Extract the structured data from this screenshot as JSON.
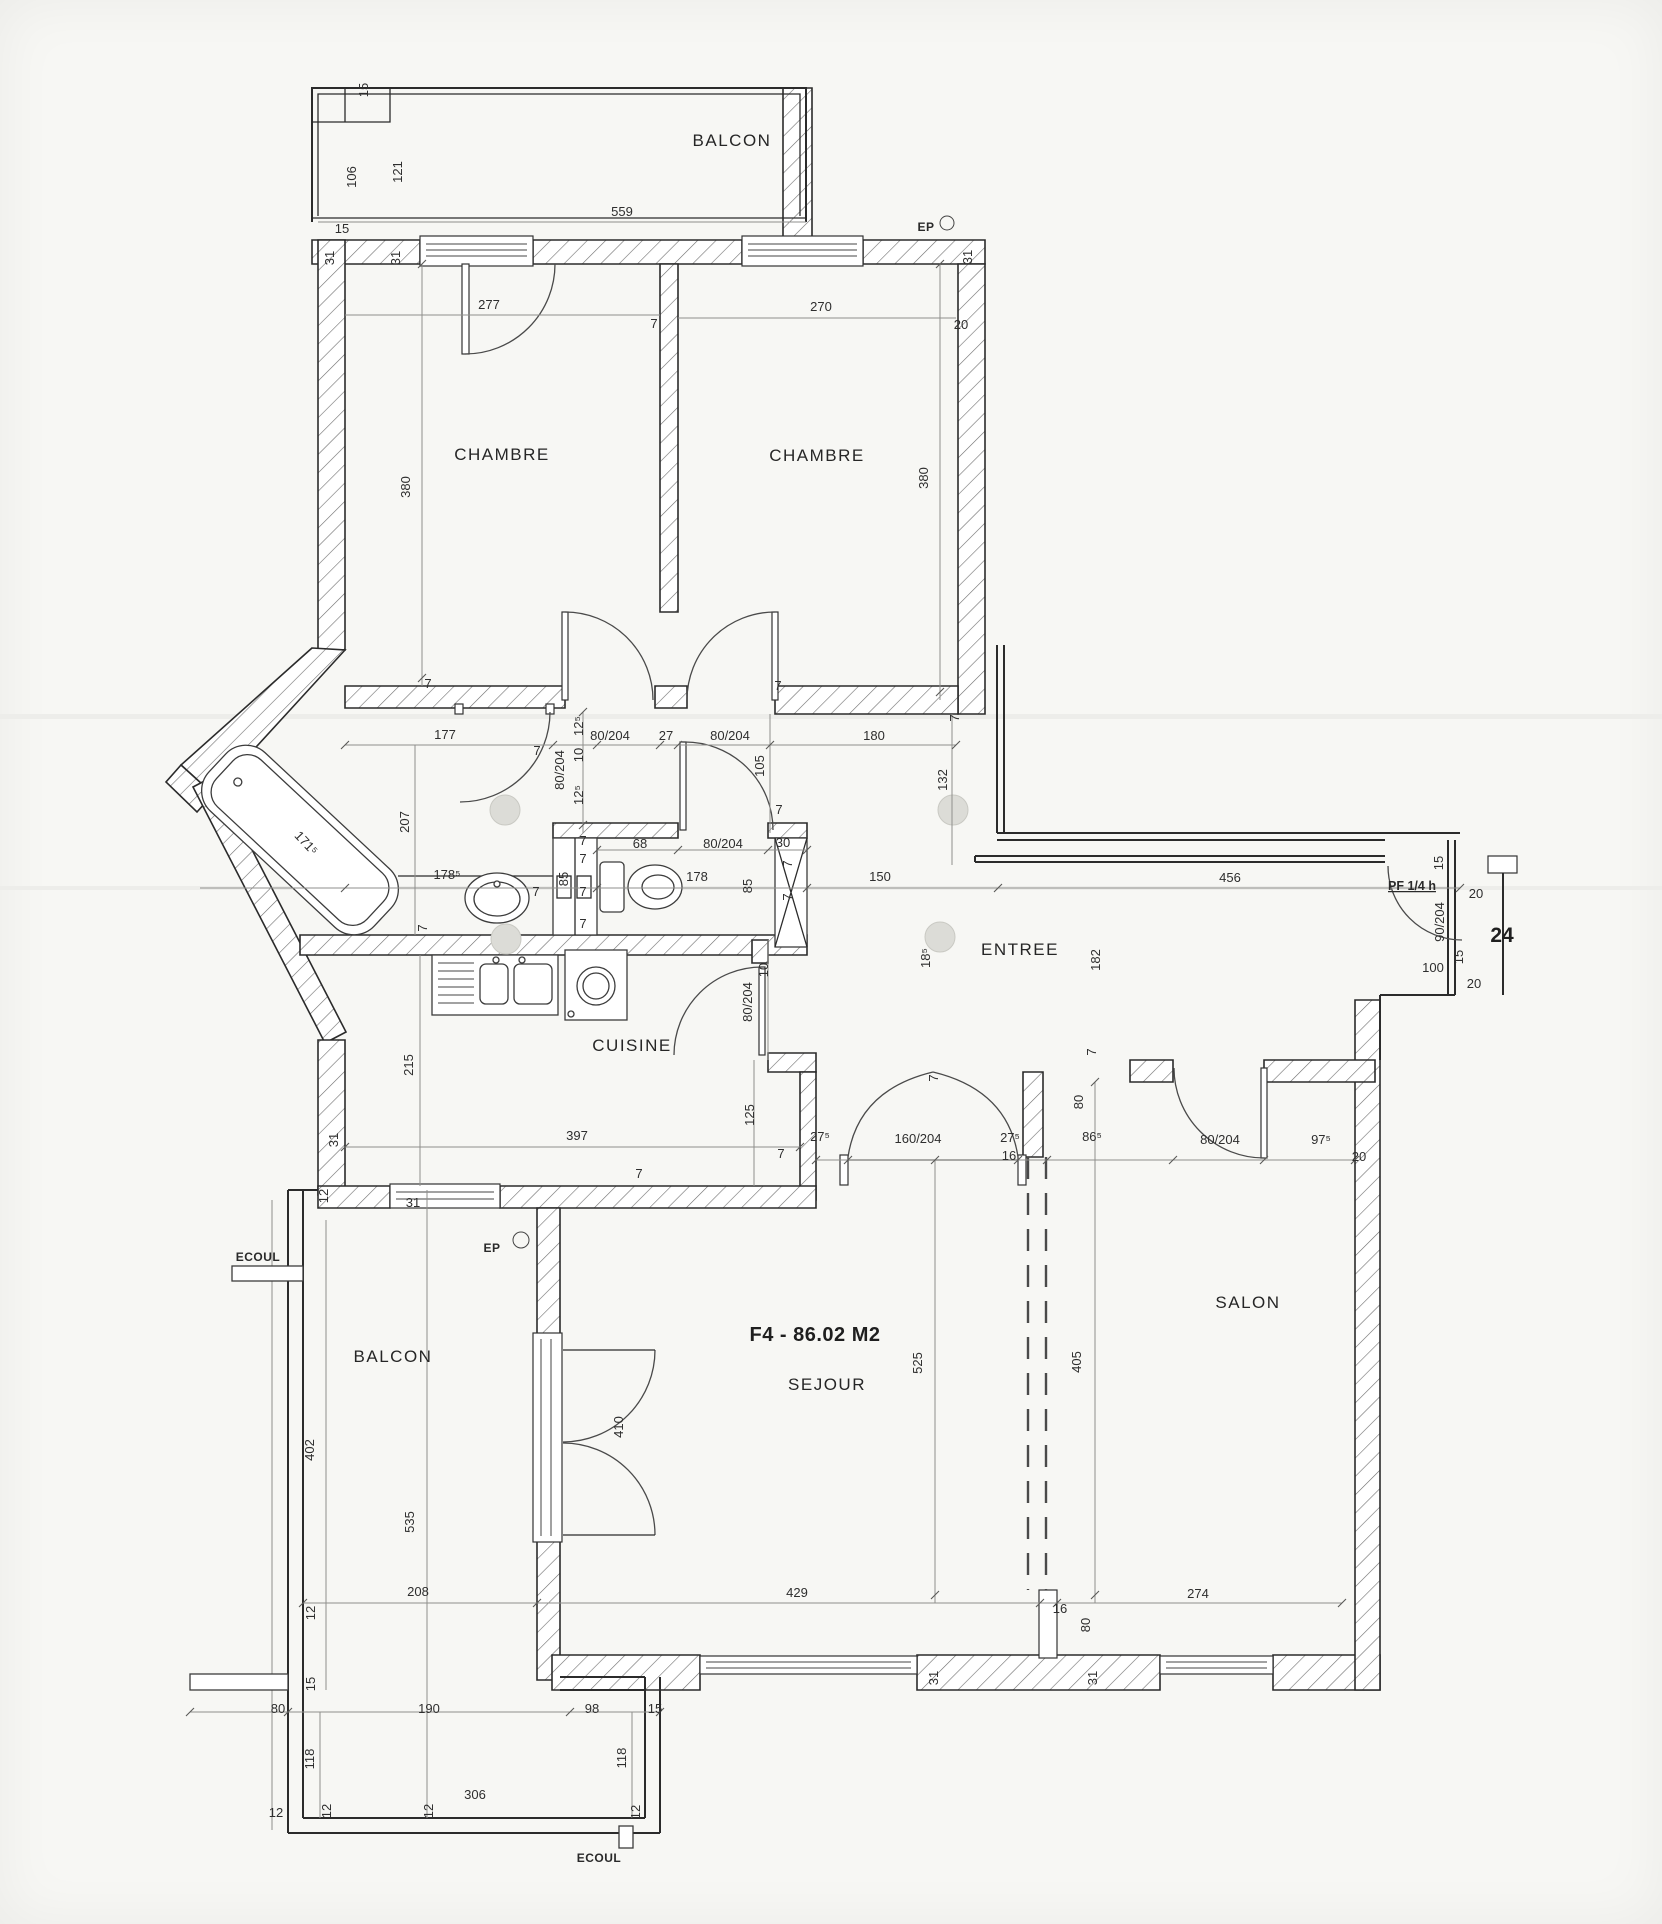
{
  "document": {
    "kind": "scanned apartment floor plan"
  },
  "theme": {
    "paper": "#f7f7f4",
    "line": "#2b2b2b",
    "hatch": "#6e6e6e",
    "dim_text": "#2e2e2e"
  },
  "plan": {
    "area_label": {
      "text": "F4 - 86.02 M2",
      "x": 815,
      "y": 1341
    },
    "unit_number": {
      "text": "24",
      "x": 1502,
      "y": 942
    },
    "door_tag": {
      "text": "PF 1/4 h",
      "x": 1412,
      "y": 890
    },
    "rooms": [
      {
        "label": "BALCON",
        "x": 732,
        "y": 146
      },
      {
        "label": "CHAMBRE",
        "x": 502,
        "y": 460
      },
      {
        "label": "CHAMBRE",
        "x": 817,
        "y": 461
      },
      {
        "label": "CUISINE",
        "x": 632,
        "y": 1051
      },
      {
        "label": "ENTREE",
        "x": 1020,
        "y": 955
      },
      {
        "label": "SALON",
        "x": 1248,
        "y": 1308
      },
      {
        "label": "SEJOUR",
        "x": 827,
        "y": 1390
      },
      {
        "label": "BALCON",
        "x": 393,
        "y": 1362
      }
    ],
    "annotations": [
      {
        "text": "EP",
        "x": 926,
        "y": 231
      },
      {
        "text": "EP",
        "x": 492,
        "y": 1252
      },
      {
        "text": "ECOUL",
        "x": 258,
        "y": 1261
      },
      {
        "text": "ECOUL",
        "x": 599,
        "y": 1862
      }
    ],
    "dims": [
      {
        "t": "15",
        "x": 368,
        "y": 90,
        "r": -90
      },
      {
        "t": "106",
        "x": 356,
        "y": 177,
        "r": -90
      },
      {
        "t": "121",
        "x": 402,
        "y": 172,
        "r": -90
      },
      {
        "t": "559",
        "x": 622,
        "y": 216
      },
      {
        "t": "15",
        "x": 342,
        "y": 233
      },
      {
        "t": "31",
        "x": 334,
        "y": 258,
        "r": -90
      },
      {
        "t": "31",
        "x": 400,
        "y": 258,
        "r": -90
      },
      {
        "t": "31",
        "x": 972,
        "y": 257,
        "r": -90
      },
      {
        "t": "277",
        "x": 489,
        "y": 309
      },
      {
        "t": "270",
        "x": 821,
        "y": 311
      },
      {
        "t": "7",
        "x": 654,
        "y": 328
      },
      {
        "t": "20",
        "x": 961,
        "y": 329
      },
      {
        "t": "380",
        "x": 410,
        "y": 487,
        "r": -90
      },
      {
        "t": "380",
        "x": 928,
        "y": 478,
        "r": -90
      },
      {
        "t": "7",
        "x": 428,
        "y": 688
      },
      {
        "t": "7",
        "x": 778,
        "y": 690
      },
      {
        "t": "177",
        "x": 445,
        "y": 739
      },
      {
        "t": "7",
        "x": 537,
        "y": 755
      },
      {
        "t": "12⁵",
        "x": 583,
        "y": 726,
        "r": -90
      },
      {
        "t": "80/204",
        "x": 564,
        "y": 770,
        "r": -90
      },
      {
        "t": "10",
        "x": 583,
        "y": 755,
        "r": -90
      },
      {
        "t": "12⁵",
        "x": 583,
        "y": 795,
        "r": -90
      },
      {
        "t": "80/204",
        "x": 610,
        "y": 740
      },
      {
        "t": "27",
        "x": 666,
        "y": 740
      },
      {
        "t": "80/204",
        "x": 730,
        "y": 740
      },
      {
        "t": "180",
        "x": 874,
        "y": 740
      },
      {
        "t": "105",
        "x": 764,
        "y": 766,
        "r": -90
      },
      {
        "t": "7",
        "x": 959,
        "y": 718,
        "r": -90
      },
      {
        "t": "132",
        "x": 947,
        "y": 780,
        "r": -90
      },
      {
        "t": "7",
        "x": 779,
        "y": 814
      },
      {
        "t": "207",
        "x": 409,
        "y": 822,
        "r": -90
      },
      {
        "t": "171⁵",
        "x": 303,
        "y": 846,
        "r": 47
      },
      {
        "t": "178⁵",
        "x": 447,
        "y": 879
      },
      {
        "t": "7",
        "x": 536,
        "y": 896
      },
      {
        "t": "7",
        "x": 427,
        "y": 928,
        "r": -90
      },
      {
        "t": "85",
        "x": 568,
        "y": 879,
        "r": -90
      },
      {
        "t": "7",
        "x": 583,
        "y": 845
      },
      {
        "t": "7",
        "x": 583,
        "y": 863
      },
      {
        "t": "7",
        "x": 583,
        "y": 896
      },
      {
        "t": "7",
        "x": 583,
        "y": 928
      },
      {
        "t": "68",
        "x": 640,
        "y": 848
      },
      {
        "t": "80/204",
        "x": 723,
        "y": 848
      },
      {
        "t": "30",
        "x": 783,
        "y": 847
      },
      {
        "t": "178",
        "x": 697,
        "y": 881
      },
      {
        "t": "85",
        "x": 752,
        "y": 886,
        "r": -90
      },
      {
        "t": "7",
        "x": 792,
        "y": 864,
        "r": -90
      },
      {
        "t": "7",
        "x": 792,
        "y": 897,
        "r": -90
      },
      {
        "t": "150",
        "x": 880,
        "y": 881
      },
      {
        "t": "456",
        "x": 1230,
        "y": 882
      },
      {
        "t": "18⁵",
        "x": 930,
        "y": 958,
        "r": -90
      },
      {
        "t": "182",
        "x": 1100,
        "y": 960,
        "r": -90
      },
      {
        "t": "10",
        "x": 768,
        "y": 970,
        "r": -90
      },
      {
        "t": "80/204",
        "x": 752,
        "y": 1002,
        "r": -90
      },
      {
        "t": "15",
        "x": 1443,
        "y": 863,
        "r": -90
      },
      {
        "t": "20",
        "x": 1476,
        "y": 898
      },
      {
        "t": "90/204",
        "x": 1444,
        "y": 922,
        "r": -90
      },
      {
        "t": "15",
        "x": 1463,
        "y": 957,
        "r": -90
      },
      {
        "t": "100",
        "x": 1433,
        "y": 972
      },
      {
        "t": "20",
        "x": 1474,
        "y": 988
      },
      {
        "t": "215",
        "x": 413,
        "y": 1065,
        "r": -90
      },
      {
        "t": "397",
        "x": 577,
        "y": 1140
      },
      {
        "t": "31",
        "x": 338,
        "y": 1140,
        "r": -90
      },
      {
        "t": "12",
        "x": 328,
        "y": 1196,
        "r": -90
      },
      {
        "t": "31",
        "x": 413,
        "y": 1207
      },
      {
        "t": "125",
        "x": 754,
        "y": 1115,
        "r": -90
      },
      {
        "t": "7",
        "x": 639,
        "y": 1178
      },
      {
        "t": "7",
        "x": 781,
        "y": 1158
      },
      {
        "t": "27⁵",
        "x": 820,
        "y": 1141
      },
      {
        "t": "160/204",
        "x": 918,
        "y": 1143
      },
      {
        "t": "27⁵",
        "x": 1010,
        "y": 1142
      },
      {
        "t": "16",
        "x": 1009,
        "y": 1160
      },
      {
        "t": "86⁵",
        "x": 1092,
        "y": 1141
      },
      {
        "t": "7",
        "x": 938,
        "y": 1078,
        "r": -90
      },
      {
        "t": "80",
        "x": 1083,
        "y": 1102,
        "r": -90
      },
      {
        "t": "80/204",
        "x": 1220,
        "y": 1144
      },
      {
        "t": "97⁵",
        "x": 1321,
        "y": 1144
      },
      {
        "t": "20",
        "x": 1359,
        "y": 1161
      },
      {
        "t": "7",
        "x": 1096,
        "y": 1052,
        "r": -90
      },
      {
        "t": "525",
        "x": 922,
        "y": 1363,
        "r": -90
      },
      {
        "t": "405",
        "x": 1081,
        "y": 1362,
        "r": -90
      },
      {
        "t": "410",
        "x": 623,
        "y": 1427,
        "r": -90
      },
      {
        "t": "429",
        "x": 797,
        "y": 1597
      },
      {
        "t": "16",
        "x": 1060,
        "y": 1613
      },
      {
        "t": "80",
        "x": 1090,
        "y": 1625,
        "r": -90
      },
      {
        "t": "274",
        "x": 1198,
        "y": 1598
      },
      {
        "t": "31",
        "x": 938,
        "y": 1678,
        "r": -90
      },
      {
        "t": "31",
        "x": 1097,
        "y": 1678,
        "r": -90
      },
      {
        "t": "402",
        "x": 314,
        "y": 1450,
        "r": -90
      },
      {
        "t": "535",
        "x": 414,
        "y": 1522,
        "r": -90
      },
      {
        "t": "208",
        "x": 418,
        "y": 1596
      },
      {
        "t": "12",
        "x": 315,
        "y": 1613,
        "r": -90
      },
      {
        "t": "15",
        "x": 315,
        "y": 1684,
        "r": -90
      },
      {
        "t": "80",
        "x": 278,
        "y": 1713
      },
      {
        "t": "190",
        "x": 429,
        "y": 1713
      },
      {
        "t": "98",
        "x": 592,
        "y": 1713
      },
      {
        "t": "15",
        "x": 655,
        "y": 1713
      },
      {
        "t": "118",
        "x": 314,
        "y": 1759,
        "r": -90
      },
      {
        "t": "118",
        "x": 626,
        "y": 1758,
        "r": -90
      },
      {
        "t": "12",
        "x": 276,
        "y": 1817
      },
      {
        "t": "12",
        "x": 331,
        "y": 1811,
        "r": -90
      },
      {
        "t": "12",
        "x": 433,
        "y": 1811,
        "r": -90
      },
      {
        "t": "306",
        "x": 475,
        "y": 1799
      },
      {
        "t": "12",
        "x": 640,
        "y": 1812,
        "r": -90
      }
    ]
  }
}
